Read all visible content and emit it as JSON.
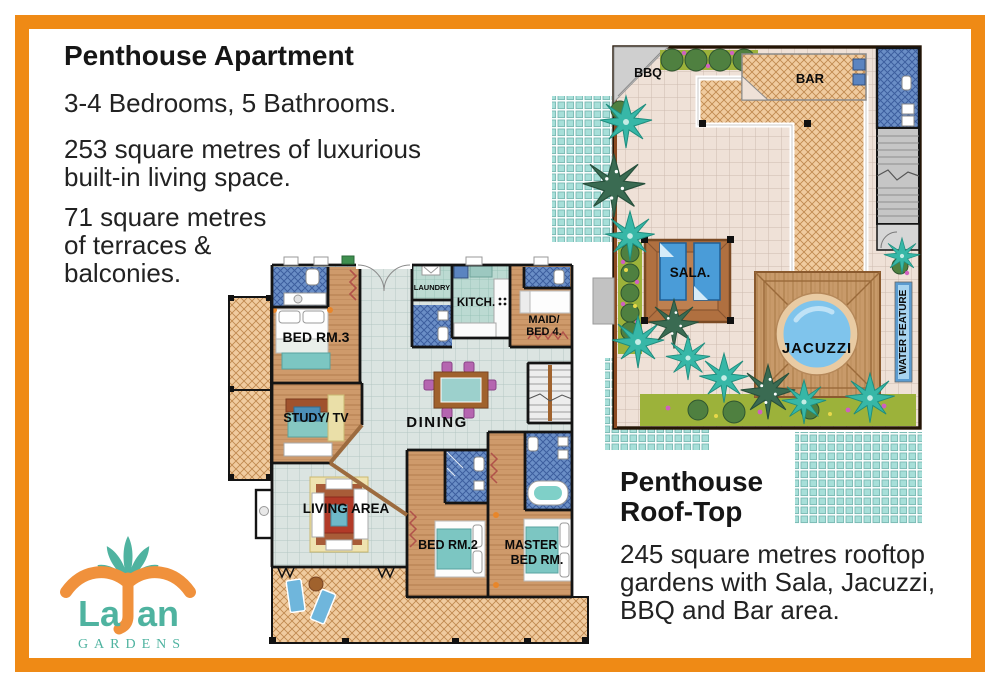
{
  "frame_color": "#EF8A15",
  "left_panel": {
    "title": "Penthouse Apartment",
    "subtitle": "3-4 Bedrooms, 5 Bathrooms.",
    "para1_lines": [
      "253 square metres of luxurious",
      "built-in living space."
    ],
    "para2_lines": [
      "71 square metres",
      "of terraces &",
      "balconies."
    ]
  },
  "roof_panel": {
    "title_lines": [
      "Penthouse",
      "Roof-Top"
    ],
    "para_lines": [
      "245 square metres rooftop",
      "gardens with Sala, Jacuzzi,",
      "BBQ and Bar area."
    ]
  },
  "logo": {
    "name_left": "La",
    "name_right": "an",
    "tagline": "GARDENS",
    "teal": "#4FB3A0",
    "orange": "#F0913C"
  },
  "apartment_plan": {
    "labels": {
      "bed3": "BED RM.3",
      "laundry": "LAUNDRY",
      "kitchen": "KITCH.",
      "maid_line1": "MAID/",
      "maid_line2": "BED 4.",
      "study": "STUDY/ TV",
      "dining": "DINING",
      "living": "LIVING AREA",
      "bed2": "BED RM.2",
      "master_line1": "MASTER",
      "master_line2": "BED RM."
    }
  },
  "roof_plan": {
    "labels": {
      "bbq": "BBQ",
      "bar": "BAR",
      "sala": "SALA.",
      "jacuzzi": "JACUZZI",
      "water": "WATER FEATURE"
    }
  }
}
